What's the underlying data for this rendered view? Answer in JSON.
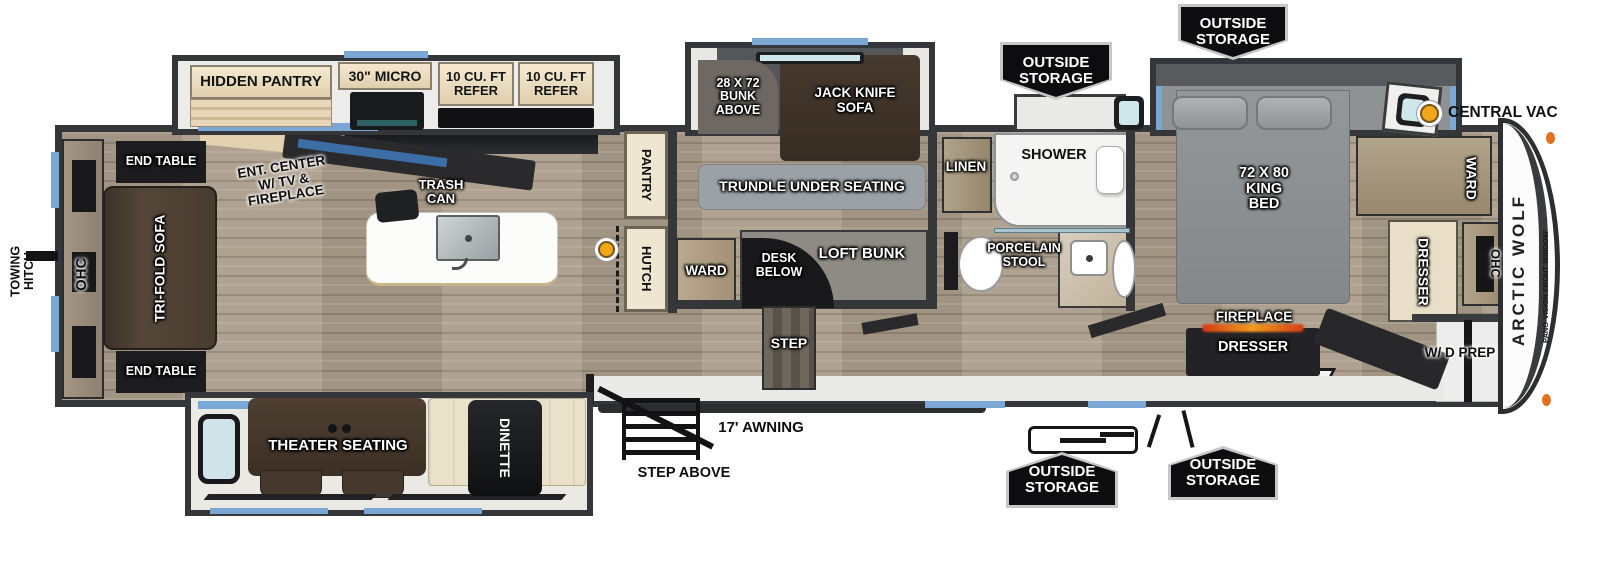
{
  "floorplan": {
    "brand": "ARCTIC WOLF",
    "colors": {
      "window_blue": "#7aa7d4",
      "wall_gray": "#35363a",
      "badge_black": "#0d0d0f",
      "vac_yellow": "#f2a71b",
      "fireplace_orange": "#e8762a"
    },
    "labels": {
      "towing_hitch": "TOWING\nHITCH",
      "ohc": "OHC",
      "end_table": "END TABLE",
      "tri_fold_sofa": "TRI-FOLD SOFA",
      "ent_center": "ENT. CENTER\nW/ TV &\nFIREPLACE",
      "hidden_pantry": "HIDDEN PANTRY",
      "micro": "30\" MICRO",
      "refer": "10 CU. FT\nREFER",
      "trash_can": "TRASH\nCAN",
      "pantry": "PANTRY",
      "hutch": "HUTCH",
      "bunk_above": "28 X 72\nBUNK\nABOVE",
      "jack_knife_sofa": "JACK KNIFE\nSOFA",
      "trundle": "TRUNDLE UNDER SEATING",
      "ward": "WARD",
      "desk_below": "DESK\nBELOW",
      "loft_bunk": "LOFT BUNK",
      "step": "STEP",
      "linen": "LINEN",
      "shower": "SHOWER",
      "porcelain_stool": "PORCELAIN\nSTOOL",
      "outside_storage": "OUTSIDE\nSTORAGE",
      "central_vac": "CENTRAL VAC",
      "king_bed": "72 X 80\nKING\nBED",
      "dresser": "DRESSER",
      "fireplace": "FIREPLACE",
      "wd_prep": "W/ D PREP",
      "theater_seating": "THEATER SEATING",
      "dinette": "DINETTE",
      "awning": "17' AWNING",
      "step_above": "STEP ABOVE",
      "brand": "ARCTIC WOLF",
      "pano_window": "PANO-VISION FRONT WINDOW"
    }
  }
}
